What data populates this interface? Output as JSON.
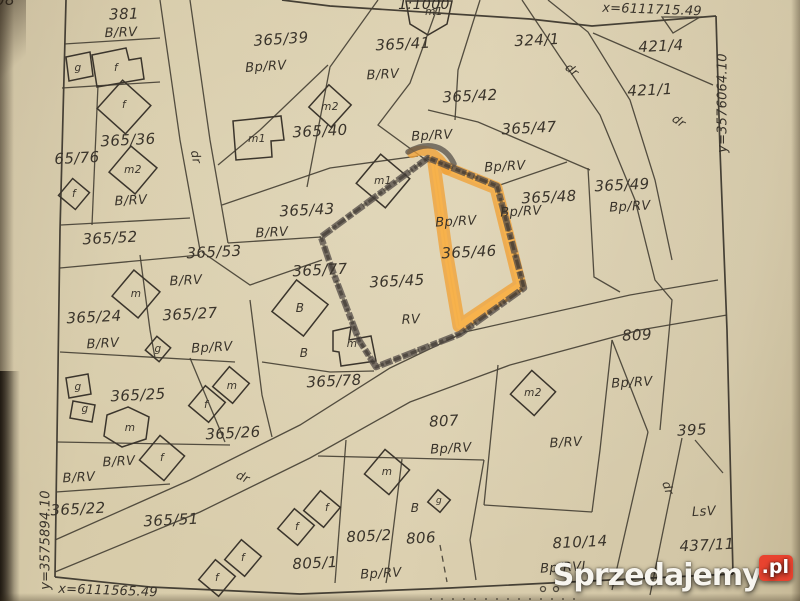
{
  "map": {
    "type": "cadastral-parcel-map-photo",
    "scale_fragment": "1:1000",
    "palette": {
      "paper": "#d7cba9",
      "line_ink": "#474135",
      "highlight_marker": "#f0a23a",
      "sketch_outline": "#57504a",
      "watermark_accent": "#e8432f"
    },
    "corner_coordinates": {
      "top": "x=6111715.49",
      "right": "y=3576064.10",
      "bottom": "x=6111565.49",
      "left": "y=3575894.10"
    },
    "highlighted_parcel": {
      "number": "365/46",
      "land_use": "Bp/RV"
    },
    "labels": [
      "381",
      "B/RV",
      "g",
      "f",
      "f",
      "365/36",
      "65/76",
      "m2",
      "f",
      "B/RV",
      "365/52",
      "dr",
      "365/39",
      "Bp/RV",
      "m2",
      "m1",
      "365/40",
      "365/41",
      "B/RV",
      "m1",
      "324/1",
      "dr",
      "421/4",
      "421/1",
      "dr",
      "x=6111715.49",
      "y=3576064.10",
      "365/42",
      "Bp/RV",
      "365/47",
      "Bp/RV",
      "365/48",
      "Bp/RV",
      "365/49",
      "Bp/RV",
      "365/43",
      "B/RV",
      "m1",
      "365/53",
      "B/RV",
      "365/77",
      "B",
      "Bp/RV",
      "365/46",
      "365/45",
      "RV",
      "m",
      "B",
      "365/78",
      "m",
      "365/24",
      "365/27",
      "B/RV",
      "g",
      "Bp/RV",
      "g",
      "365/25",
      "g",
      "m",
      "f",
      "m",
      "365/26",
      "B/RV",
      "f",
      "B/RV",
      "365/22",
      "dr",
      "365/51",
      "f",
      "f",
      "f",
      "f",
      "805/1",
      "Bp/RV",
      "805/2",
      "806",
      "B",
      "g",
      "m",
      "807",
      "Bp/RV",
      "808",
      "B/RV",
      "m2",
      "809",
      "Bp/RV",
      "395",
      "LsV",
      "437/11",
      "810/14",
      "Bp/RVI",
      "dr",
      "x=6111565.49",
      "y=3575894.10"
    ]
  },
  "watermark": {
    "brand": "Sprzedajemy",
    "tld": ".pl"
  }
}
